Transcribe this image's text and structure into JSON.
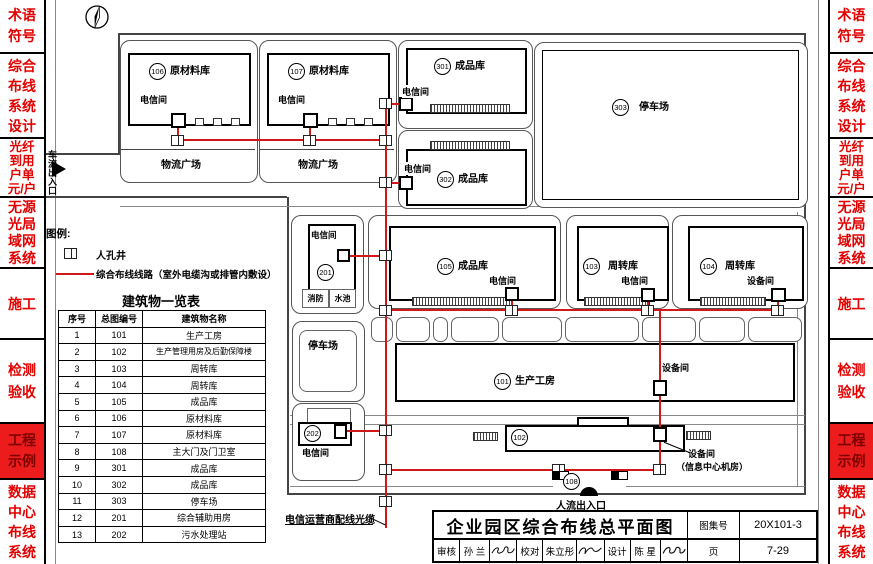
{
  "sidebar": {
    "sections": [
      {
        "lines": [
          "术语",
          "符号"
        ]
      },
      {
        "lines": [
          "综合",
          "布线",
          "系统",
          "设计"
        ]
      },
      {
        "lines": [
          "光纤",
          "到用",
          "户单",
          "元/户"
        ]
      },
      {
        "lines": [
          "无源",
          "光局",
          "域网",
          "系统"
        ]
      },
      {
        "lines": [
          "施工"
        ]
      },
      {
        "lines": [
          "检测",
          "验收"
        ]
      },
      {
        "lines": [
          "工程",
          "示例"
        ],
        "highlight": true
      },
      {
        "lines": [
          "数据",
          "中心",
          "布线",
          "系统"
        ]
      }
    ]
  },
  "legend": {
    "heading": "图例:",
    "manhole_label": "人孔井",
    "cable_label": "综合布线线路（室外电缆沟或排管内敷设）"
  },
  "building_table": {
    "title": "建筑物一览表",
    "headers": [
      "序号",
      "总图编号",
      "建筑物名称"
    ],
    "rows": [
      [
        "1",
        "101",
        "生产工房"
      ],
      [
        "2",
        "102",
        "生产管理用房及后勤保障楼"
      ],
      [
        "3",
        "103",
        "周转库"
      ],
      [
        "4",
        "104",
        "周转库"
      ],
      [
        "5",
        "105",
        "成品库"
      ],
      [
        "6",
        "106",
        "原材料库"
      ],
      [
        "7",
        "107",
        "原材料库"
      ],
      [
        "8",
        "108",
        "主大门及门卫室"
      ],
      [
        "9",
        "301",
        "成品库"
      ],
      [
        "10",
        "302",
        "成品库"
      ],
      [
        "11",
        "303",
        "停车场"
      ],
      [
        "12",
        "201",
        "综合辅助用房"
      ],
      [
        "13",
        "202",
        "污水处理站"
      ]
    ]
  },
  "plan": {
    "telecom_room": "电信间",
    "equipment_room": "设备间",
    "info_center_room": "（信息中心机房）",
    "logistics_plaza": "物流广场",
    "parking": "停车场",
    "fire_pool_1": "消防",
    "fire_pool_2": "水池",
    "vehicle_entrance": "车流出入口",
    "pedestrian_entrance": "人流出入口",
    "carrier_cable": "电信运营商配线光缆",
    "buildings": {
      "b101": {
        "no": "101",
        "name": "生产工房"
      },
      "b102": {
        "no": "102"
      },
      "b103": {
        "no": "103",
        "name": "周转库"
      },
      "b104": {
        "no": "104",
        "name": "周转库"
      },
      "b105": {
        "no": "105",
        "name": "成品库"
      },
      "b106": {
        "no": "106",
        "name": "原材料库"
      },
      "b107": {
        "no": "107",
        "name": "原材料库"
      },
      "b108": {
        "no": "108"
      },
      "b201": {
        "no": "201"
      },
      "b202": {
        "no": "202"
      },
      "b301": {
        "no": "301",
        "name": "成品库"
      },
      "b302": {
        "no": "302",
        "name": "成品库"
      },
      "b303": {
        "no": "303",
        "name": "停车场"
      }
    }
  },
  "title_block": {
    "title": "企业园区综合布线总平面图",
    "sheet_no_label": "图集号",
    "sheet_no": "20X101-3",
    "review_label": "审核",
    "reviewer": "孙 兰",
    "proof_label": "校对",
    "proofreader": "朱立彤",
    "design_label": "设计",
    "designer": "陈 星",
    "page_label": "页",
    "page_no": "7-29"
  }
}
